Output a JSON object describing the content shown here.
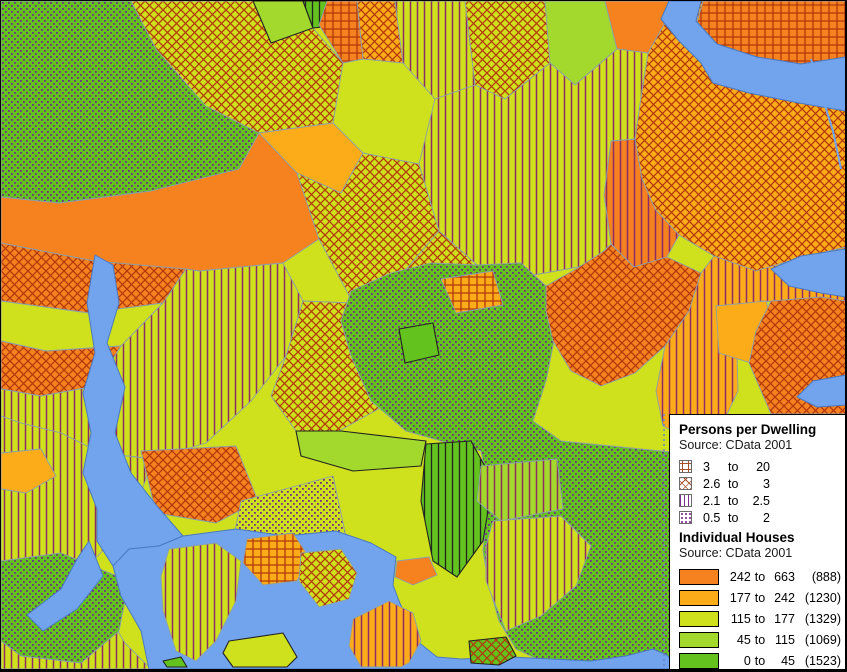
{
  "map": {
    "description": "thematic-cadastral-map",
    "palette": {
      "orange": "#F5821E",
      "amber": "#FBAC18",
      "yellow_green": "#CFE01D",
      "light_green": "#A3D82C",
      "green": "#63C21E",
      "water": "#72A4ED",
      "hatch_red": "#B2380C",
      "hatch_purple_line": "#8E2C66",
      "hatch_purple_dot": "#6F2D86"
    }
  },
  "legend": {
    "persons": {
      "title": "Persons per Dwelling",
      "source": "Source: CData 2001",
      "items": [
        {
          "pattern": "grid",
          "from": "3",
          "to_word": "to",
          "to": "20"
        },
        {
          "pattern": "x",
          "from": "2.6",
          "to_word": "to",
          "to": "3"
        },
        {
          "pattern": "vert",
          "from": "2.1",
          "to_word": "to",
          "to": "2.5"
        },
        {
          "pattern": "dots",
          "from": "0.5",
          "to_word": "to",
          "to": "2"
        }
      ]
    },
    "houses": {
      "title": "Individual Houses",
      "source": "Source: CData 2001",
      "items": [
        {
          "color": "#F5821E",
          "from": "242",
          "to_word": "to",
          "to": "663",
          "count": "(888)"
        },
        {
          "color": "#FBAC18",
          "from": "177",
          "to_word": "to",
          "to": "242",
          "count": "(1230)"
        },
        {
          "color": "#CFE01D",
          "from": "115",
          "to_word": "to",
          "to": "177",
          "count": "(1329)"
        },
        {
          "color": "#A3D82C",
          "from": "45",
          "to_word": "to",
          "to": "115",
          "count": "(1069)"
        },
        {
          "color": "#63C21E",
          "from": "0",
          "to_word": "to",
          "to": "45",
          "count": "(1523)"
        }
      ]
    }
  }
}
